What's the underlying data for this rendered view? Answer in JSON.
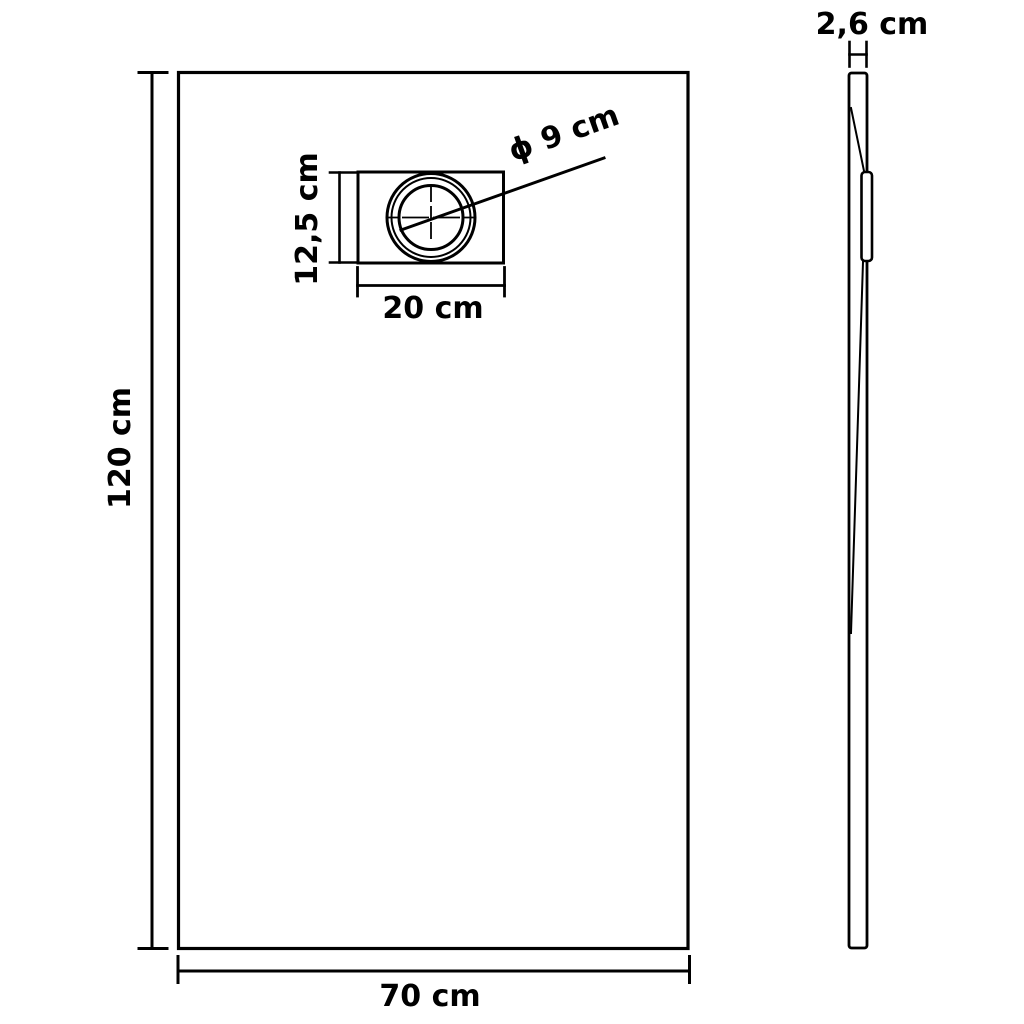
{
  "diagram": {
    "type": "technical-dimension-drawing",
    "subject": "rectangular shower base tray, front view and side profile view",
    "colors": {
      "line": "#000000",
      "background": "#ffffff"
    },
    "front_view": {
      "height_label": "120 cm",
      "width_label": "70 cm",
      "drain_box": {
        "height_label": "12,5 cm",
        "width_label": "20 cm",
        "diameter_label": "ϕ 9 cm"
      }
    },
    "side_view": {
      "thickness_label": "2,6 cm"
    }
  }
}
